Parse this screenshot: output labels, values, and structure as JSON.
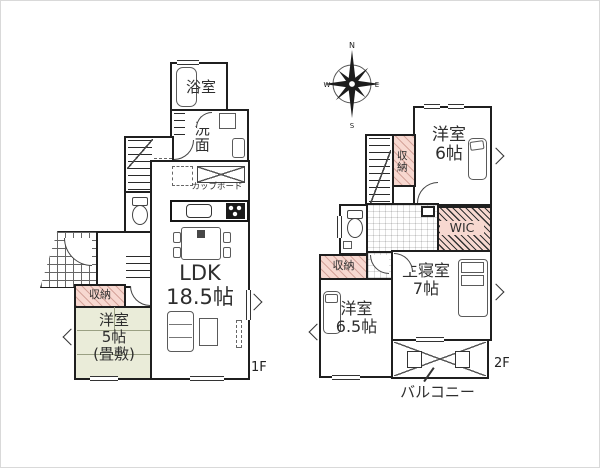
{
  "floor1": {
    "floor_label": "1F",
    "bath_label": "浴室",
    "washroom_label": "洗面",
    "cupboard_label": "カップボード",
    "ldk_label": "LDK\n18.5帖",
    "closet_label": "収納",
    "tatami_room_label": "洋室\n5帖\n(畳敷)"
  },
  "floor2": {
    "floor_label": "2F",
    "compass": {
      "north": "N",
      "west": "W",
      "east": "E",
      "south": "S"
    },
    "bedroom6_label": "洋室\n6帖",
    "closet_top_label": "収納",
    "wic_label": "WIC",
    "closet_left_label": "収納",
    "master_bedroom_label": "主寝室\n7帖",
    "bedroom65_label": "洋室\n6.5帖",
    "balcony_label": "バルコニー"
  },
  "colors": {
    "wall": "#1f1f1f",
    "closet_pink": "#f7d8d0",
    "tatami_green": "#eaecd9",
    "background": "#ffffff"
  }
}
